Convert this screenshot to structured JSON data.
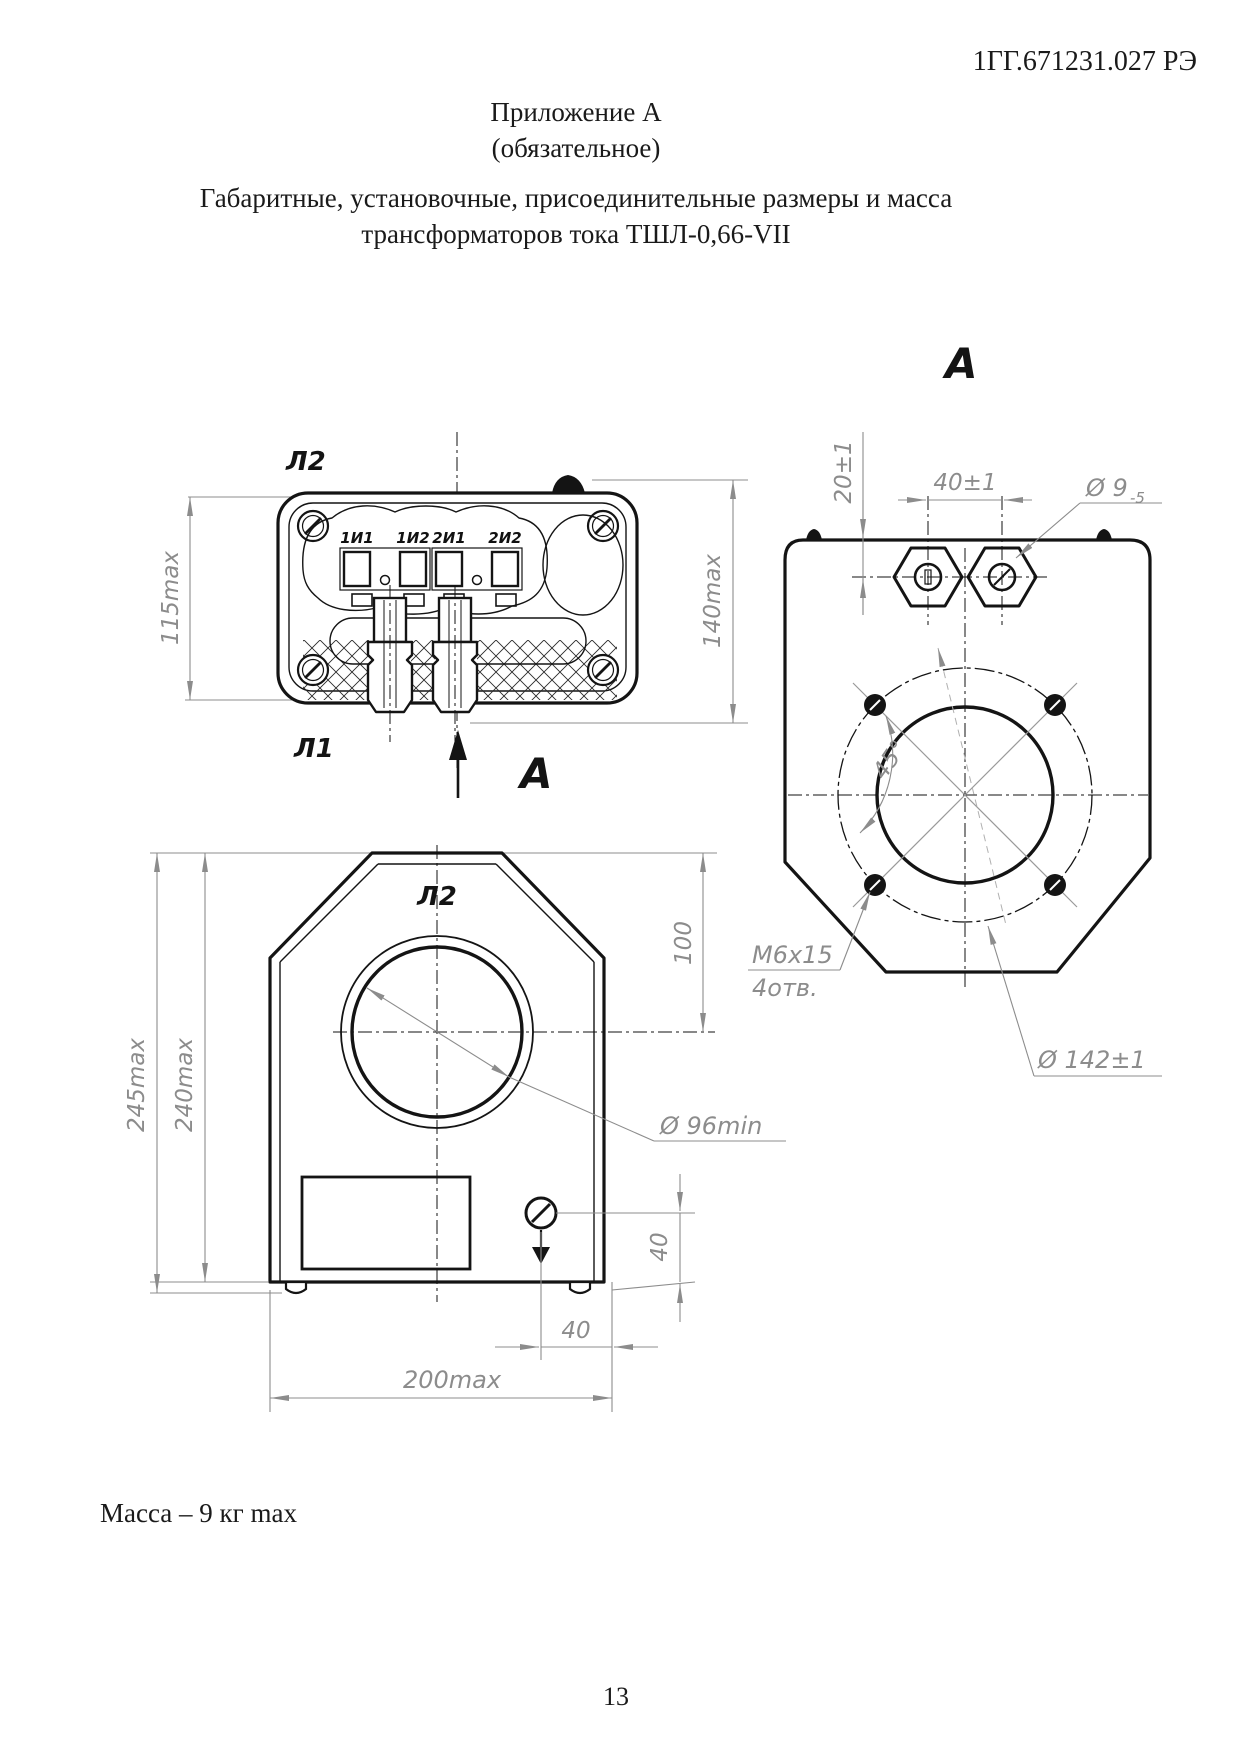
{
  "page": {
    "doc_number": "1ГГ.671231.027 РЭ",
    "page_number": "13"
  },
  "title": {
    "appendix": "Приложение А",
    "note": "(обязательное)",
    "subtitle_line1": "Габаритные, установочные, присоединительные размеры и масса",
    "subtitle_line2": "трансформаторов тока ТШЛ-0,66-VII"
  },
  "drawing": {
    "top_view": {
      "label_top": "Л2",
      "label_bottom": "Л1",
      "terminals": [
        "1И1",
        "1И2",
        "2И1",
        "2И2"
      ],
      "dim_height": "115max",
      "dim_depth": "140max",
      "view_arrow_label": "А"
    },
    "view_a": {
      "title": "А",
      "dim_offset": "20±1",
      "dim_spacing": "40±1",
      "dim_hole": "Ø 9",
      "dim_hole_tol": "-5",
      "dim_angle": "45°",
      "thread_spec": "М6х15",
      "thread_holes": "4отв.",
      "dim_bolt_circle": "Ø 142±1"
    },
    "front_view": {
      "label_top": "Л2",
      "dim_height_outer": "245max",
      "dim_height": "240max",
      "dim_center": "100",
      "dim_window": "Ø 96min",
      "dim_screw_v": "40",
      "dim_screw_h": "40",
      "dim_width": "200max"
    }
  },
  "footer": {
    "mass_note": "Масса – 9 кг max"
  }
}
